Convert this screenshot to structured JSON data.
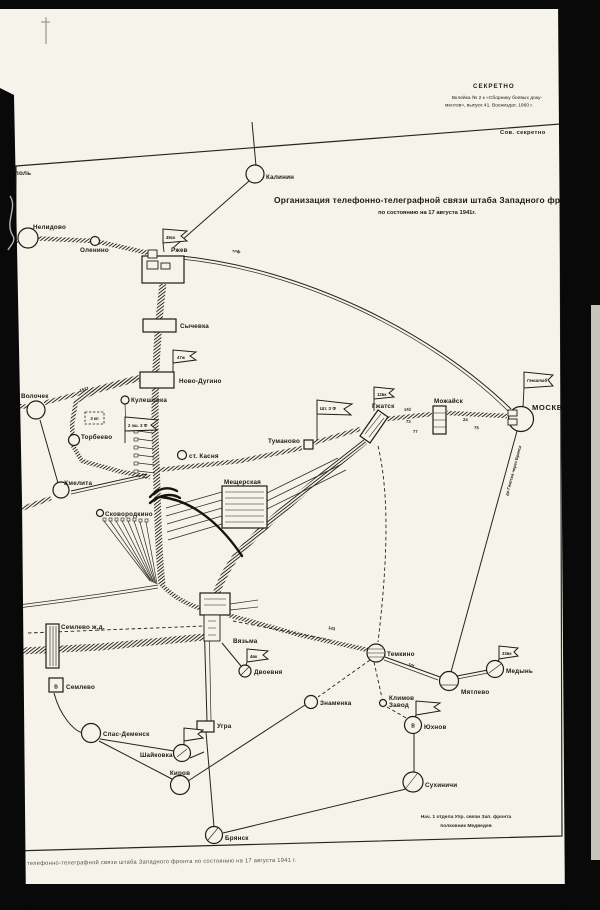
{
  "header": {
    "classification": "СЕКРЕТНО",
    "imprint_line1": "Вклейка № 2 к «Сборнику боевых доку-",
    "imprint_line2": "ментов», выпуск 41. Воениздат, 1960 г.",
    "stamp": "Сов. секретно"
  },
  "title": {
    "line1": "Организация телефонно-телеграфной связи штаба Западного фронта",
    "line2": "по состоянию на 17 августа 1941г."
  },
  "signature": {
    "line1": "Нач. 1 отдела Упр. связи Зап. фронта",
    "line2": "полковник Медведев"
  },
  "footer": {
    "caption": "телефонно-телеграфной связи штаба  Западного  фронта  по  состоянию на 17 августа 1941 г."
  },
  "nodes": {
    "pol": {
      "label": "поль"
    },
    "kalinin": {
      "label": "Калинин"
    },
    "nelidovo": {
      "label": "Нелидово"
    },
    "olenino": {
      "label": "Оленино"
    },
    "rzhev": {
      "label": "Ржев"
    },
    "sychevka": {
      "label": "Сычевка"
    },
    "novo_dugino": {
      "label": "Ново-Дугино"
    },
    "volochek": {
      "label": "Волочек"
    },
    "kuleshovka": {
      "label": "Кулешовка"
    },
    "torbeevo": {
      "label": "Торбеево"
    },
    "khmelita": {
      "label": "Хмелита"
    },
    "st_kasnya": {
      "label": "ст. Касня"
    },
    "tumanovo": {
      "label": "Туманово"
    },
    "meshcherskaya": {
      "label": "Мещерская"
    },
    "skovorodkino": {
      "label": "Сковородкино"
    },
    "gzhatsk": {
      "label": "Гжатск"
    },
    "mozhaisk": {
      "label": "Можайск"
    },
    "moskva": {
      "label": "МОСКВА"
    },
    "semlevo_zhd": {
      "label": "Семлево ж.д."
    },
    "semlevo": {
      "label": "Семлево",
      "marker": "В"
    },
    "vyazma": {
      "label": "Вязьма"
    },
    "dvoevnya": {
      "label": "Двоевня"
    },
    "znamenka": {
      "label": "Знаменка"
    },
    "temkino": {
      "label": "Темкино"
    },
    "myatlevo": {
      "label": "Мятлево"
    },
    "medyn": {
      "label": "Медынь"
    },
    "klimov_zavod": {
      "label_line1": "Климов",
      "label_line2": "Завод"
    },
    "yukhnov": {
      "label": "Юхнов",
      "marker": "В"
    },
    "sukhinichi": {
      "label": "Сухиничи"
    },
    "ugra": {
      "label": "Угра"
    },
    "spas_demensk": {
      "label": "Спас-Деменск"
    },
    "shaykovka": {
      "label": "Шайковка"
    },
    "kirov": {
      "label": "Киров"
    },
    "bryansk": {
      "label": "Брянск"
    }
  },
  "flags": {
    "genshtab": {
      "label": "Генштаб"
    },
    "front_hq": {
      "label": "Шт. З Ф"
    },
    "second_echelon": {
      "label": "2 эш. З Ф"
    },
    "rzhev": {
      "label": "49ск"
    },
    "novo_dugino": {
      "label": "47ж"
    },
    "gzhatsk": {
      "label": "12вк"
    },
    "dvoevnya": {
      "label": "4вк"
    },
    "medyn": {
      "label": "33вк"
    }
  },
  "unit_box": {
    "label": "3 кп"
  },
  "line_labels": {
    "tlf": {
      "text": "тлф"
    },
    "w1527": {
      "text": "1527"
    },
    "n143a": {
      "text": "143"
    },
    "n73": {
      "text": "73"
    },
    "n77": {
      "text": "77"
    },
    "n24": {
      "text": "24"
    },
    "n75": {
      "text": "75"
    },
    "n143b": {
      "text": "143"
    },
    "tlg": {
      "text": "тлг"
    },
    "moskva_route": {
      "text": "до Гжатска через Брянск"
    }
  },
  "colors": {
    "paper": "#f6f3ea",
    "ink": "#1b1b16",
    "scan_border": "#090909"
  }
}
